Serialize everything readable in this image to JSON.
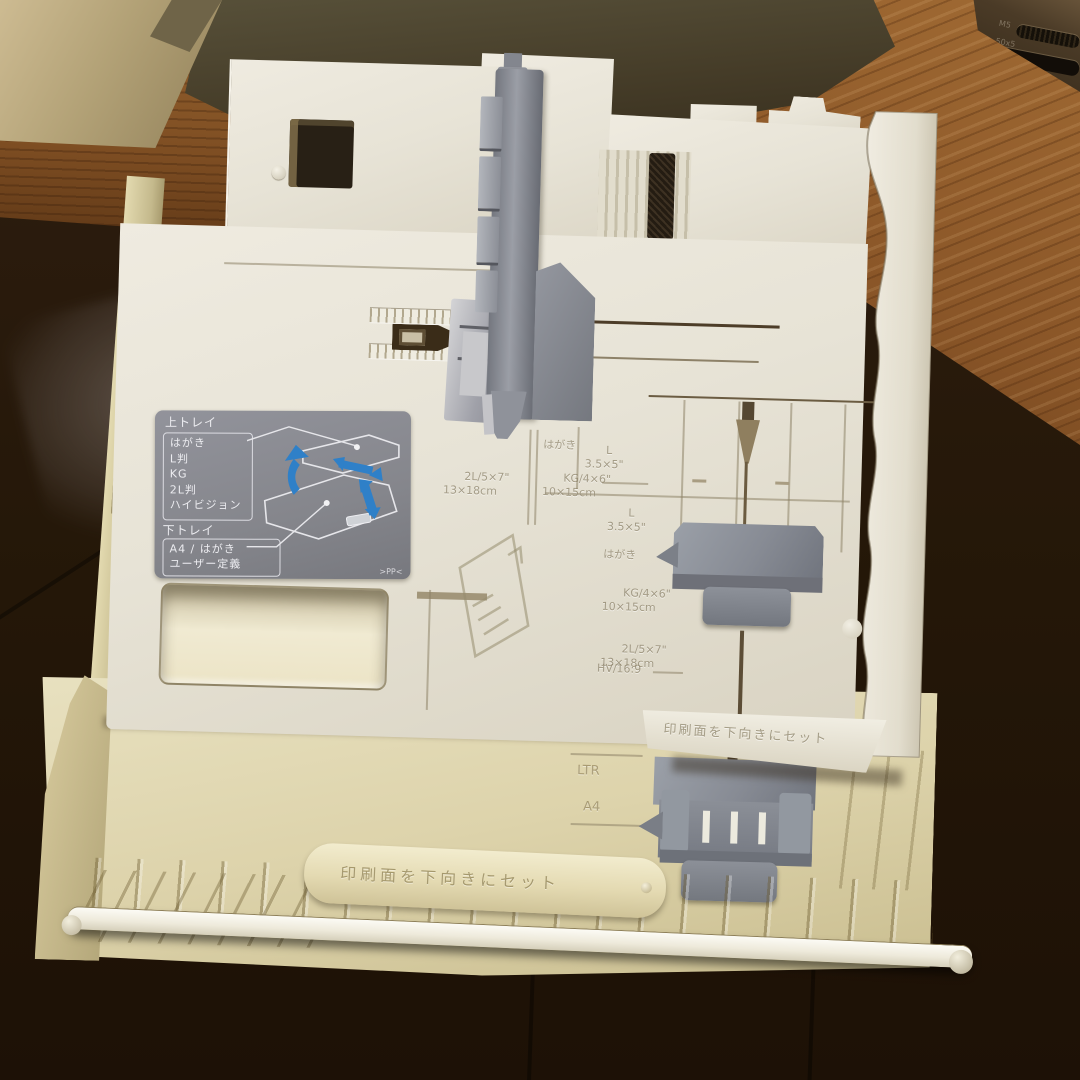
{
  "sticker": {
    "upper_tray_title": "上トレイ",
    "upper_sizes": [
      "はがき",
      "L判",
      "KG",
      "2L判",
      "ハイビジョン"
    ],
    "lower_tray_title": "下トレイ",
    "lower_sizes": [
      "A4 / はがき",
      "ユーザー定義"
    ],
    "material_mark": ">PP<"
  },
  "upper_tray_markings": {
    "size_2l": "2L/5×7\"",
    "size_2l_cm": "13×18cm",
    "hagaki": "はがき",
    "size_kg": "KG/4×6\"",
    "size_kg_cm": "10×15cm",
    "size_l": "L",
    "size_l_inch": "3.5×5\"",
    "face_down_notice": "印刷面を下向きにセット"
  },
  "right_rail_markings": {
    "size_l": "L",
    "size_l_inch": "3.5×5\"",
    "hagaki": "はがき",
    "size_kg": "KG/4×6\"",
    "size_kg_cm": "10×15cm",
    "size_2l": "2L/5×7\"",
    "size_2l_cm": "13×18cm",
    "size_hv": "HV/16:9"
  },
  "lower_tray_markings": {
    "ltr": "LTR",
    "a4": "A4",
    "face_down_notice": "印刷面を下向きにセット"
  },
  "printer_body": {
    "vent_text_line1": "M5",
    "vent_text_line2": "50x5",
    "vent_text_line3": "CF"
  },
  "palette": {
    "upper_tray_white": "#e9e5d8",
    "lower_tray_ivory": "#e0d7ae",
    "guide_gray": "#8a8d95",
    "sticker_gray": "#87888c",
    "arrow_blue": "#2f80c8",
    "wood_brown": "#8a5a2c",
    "floor_dark": "#241709"
  }
}
